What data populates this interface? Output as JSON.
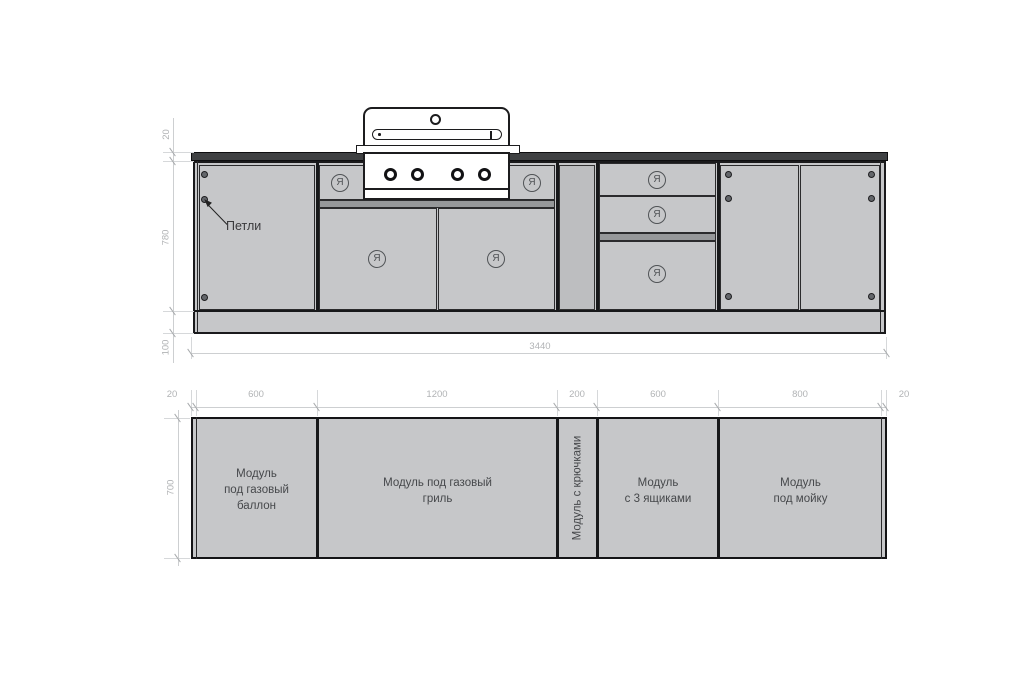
{
  "elevation": {
    "dims": {
      "countertop_thickness": "20",
      "body_height": "780",
      "plinth_height": "100",
      "total_width": "3440"
    },
    "hinges_label": "Петли",
    "handle_symbol": "Я"
  },
  "plan": {
    "dims": {
      "depth": "700",
      "segments": [
        "20",
        "600",
        "1200",
        "200",
        "600",
        "800",
        "20"
      ]
    },
    "modules": [
      {
        "lines": [
          "Модуль",
          "под газовый",
          "баллон"
        ]
      },
      {
        "lines": [
          "Модуль под газовый",
          "гриль"
        ]
      },
      {
        "lines": [
          "Модуль с крючками"
        ]
      },
      {
        "lines": [
          "Модуль",
          "с 3 ящиками"
        ]
      },
      {
        "lines": [
          "Модуль",
          "под мойку"
        ]
      }
    ]
  }
}
